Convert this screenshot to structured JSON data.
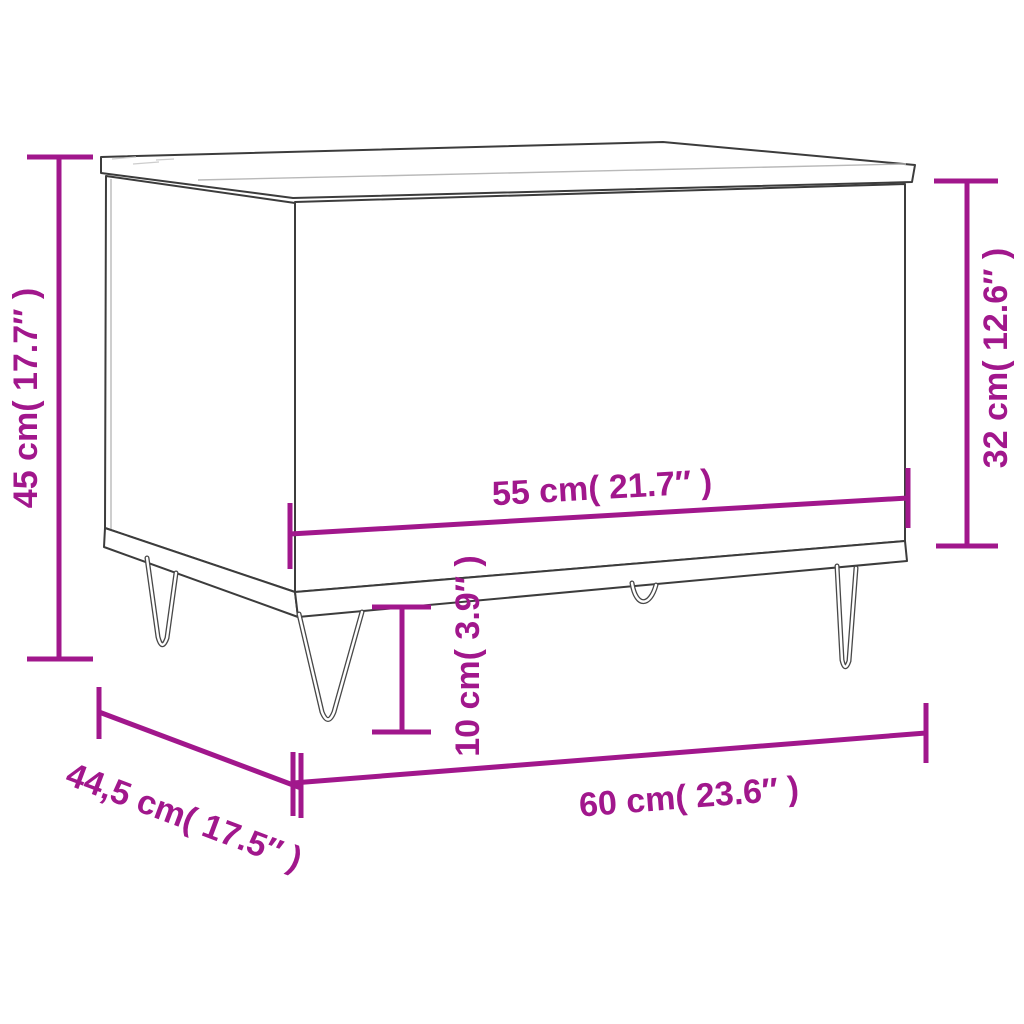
{
  "colors": {
    "accent": "#a1178c",
    "line_art": "#3c3c3c",
    "background": "#ffffff"
  },
  "dimensions": {
    "total_height": {
      "label": "45 cm( 17.7″ )"
    },
    "body_height": {
      "label": "32 cm( 12.6″ )"
    },
    "top_width": {
      "label": "55 cm( 21.7″ )"
    },
    "leg_height": {
      "label": "10 cm( 3.9″ )"
    },
    "total_width": {
      "label": "60 cm( 23.6″ )"
    },
    "depth": {
      "label": "44,5 cm( 17.5″ )"
    }
  }
}
